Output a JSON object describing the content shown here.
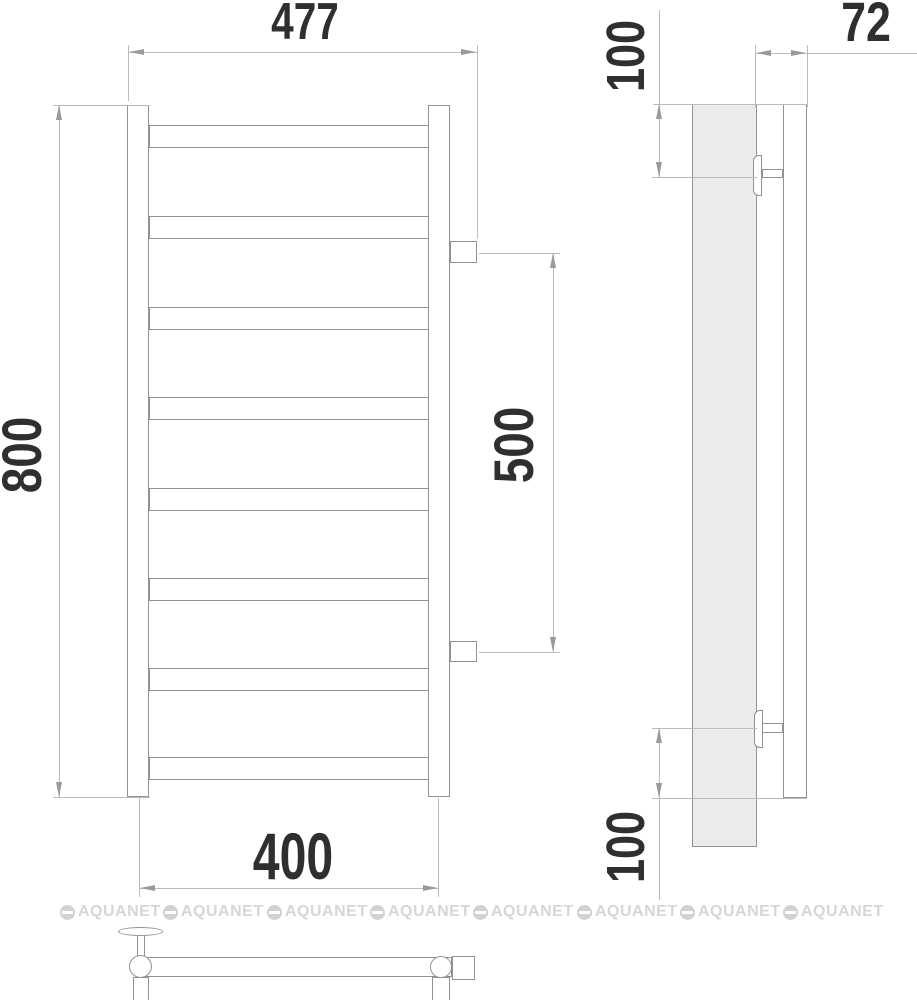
{
  "dimensions": {
    "overall_width": "477",
    "overall_height": "800",
    "connection_spacing": "500",
    "bracket_spacing": "400",
    "top_bracket_offset": "100",
    "bottom_bracket_offset": "100",
    "wall_depth": "72"
  },
  "watermark": {
    "text": "AQUANET",
    "icon": "aquanet-logo-circle-icon",
    "instances": 8,
    "color": "#d6d6d6"
  },
  "drawing": {
    "rung_count": 8,
    "colors": {
      "outline": "#929292",
      "dimension_line": "#bcbcbc",
      "dimension_text": "#2f2f2f",
      "panel_fill": "#ebebeb",
      "background": "#ffffff"
    }
  }
}
